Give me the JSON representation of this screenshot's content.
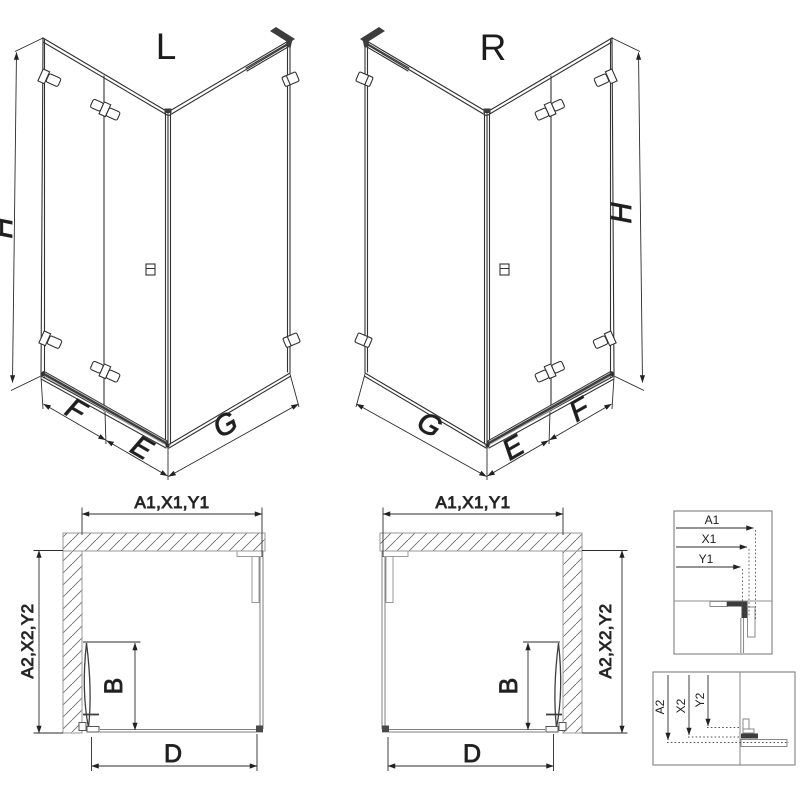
{
  "colors": {
    "line": "#333333",
    "secondary_gray": "#8f8f8f",
    "dark_fill": "#3d3d3d",
    "background": "#ffffff"
  },
  "iso_left": {
    "variant_label": "L",
    "dim_height": "H",
    "dim_door": "F",
    "dim_fixed": "E",
    "dim_side": "G"
  },
  "iso_right": {
    "variant_label": "R",
    "dim_height": "H",
    "dim_door": "F",
    "dim_fixed": "E",
    "dim_side": "G"
  },
  "plan_left": {
    "dim_top": "A1,X1,Y1",
    "dim_side": "A2,X2,Y2",
    "dim_door_width": "B",
    "dim_entry": "D"
  },
  "plan_right": {
    "dim_top": "A1,X1,Y1",
    "dim_side": "A2,X2,Y2",
    "dim_door_width": "B",
    "dim_entry": "D"
  },
  "detail_top": {
    "dim_a1": "A1",
    "dim_x1": "X1",
    "dim_y1": "Y1"
  },
  "detail_bottom": {
    "dim_a2": "A2",
    "dim_x2": "X2",
    "dim_y2": "Y2"
  }
}
